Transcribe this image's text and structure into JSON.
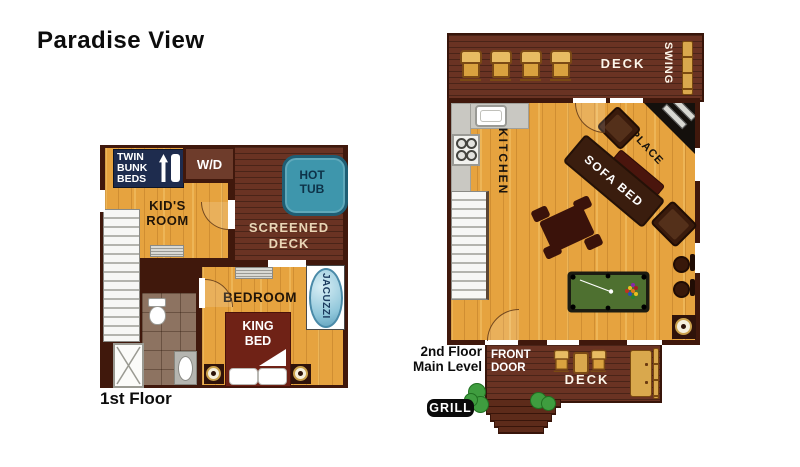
{
  "title": "Paradise View",
  "floor1": {
    "caption": "1st Floor",
    "bunk_label": "TWIN\nBUNK\nBEDS",
    "wd_label": "W/D",
    "kids_room_label": "KID'S\nROOM",
    "screened_deck_label": "SCREENED\nDECK",
    "hot_tub_label": "HOT\nTUB",
    "bedroom_label": "BEDROOM",
    "king_bed_label": "KING\nBED",
    "jacuzzi_label": "JACUZZI"
  },
  "floor2": {
    "caption": "2nd Floor\nMain Level",
    "deck_top_label": "DECK",
    "swing_label": "SWING",
    "kitchen_label": "KITCHEN",
    "fireplace_label": "FIREPLACE",
    "sofa_bed_label": "SOFA BED",
    "front_door_label": "FRONT\nDOOR",
    "deck_bottom_label": "DECK",
    "grill_label": "GRILL"
  },
  "colors": {
    "wall": "#40180c",
    "wood_floor": "#e6a33f",
    "deck_planks": "#6a3323",
    "hot_tub": "#3e96ac",
    "bunk_box_navy": "#1e2c4e",
    "king_bed_red": "#6f2216",
    "pool_felt_green": "#4e7030",
    "porch_furniture_gold": "#d9a84d",
    "bush_green": "#3f9d3f"
  }
}
